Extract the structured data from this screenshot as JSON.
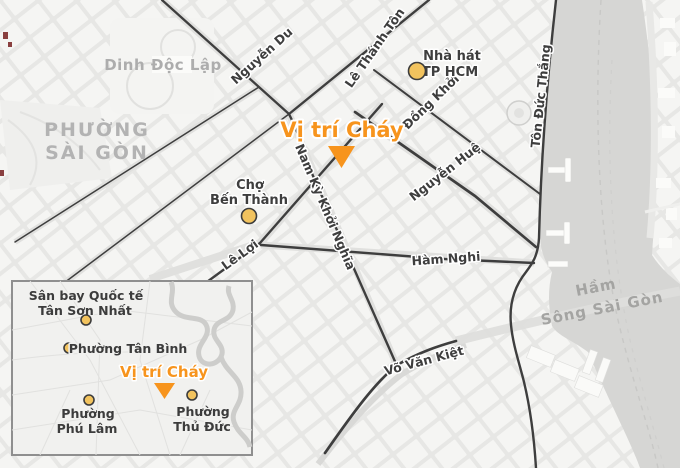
{
  "title": "Vị trí Cháy — bản đồ TP HCM",
  "colors": {
    "accent_orange": "#F7941D",
    "marker_yellow": "#F2C35E",
    "road_dark": "#3E3E3E",
    "river_gray": "#D7D7D5",
    "area_label_gray": "#B3B3B3"
  },
  "main_map": {
    "fire_label": "Vị trí Cháy",
    "areas": {
      "phuong_saigon_line1": "PHƯỜNG",
      "phuong_saigon_line2": "SÀI GÒN",
      "dinh_doc_lap": "Dinh Độc Lập",
      "ham_line1": "Hầm",
      "ham_line2": "Sông Sài Gòn"
    },
    "streets": {
      "nguyen_du": "Nguyễn Du",
      "le_thanh_ton": "Lê Thánh Tôn",
      "dong_khoi": "Đồng Khởi",
      "nguyen_hue": "Nguyễn Huệ",
      "nam_ky_khoi_nghia": "Nam Kỳ Khởi Nghĩa",
      "ton_duc_thang": "Tôn Đức Thắng",
      "le_loi": "Lê Lợi",
      "ham_nghi": "Hàm Nghi",
      "vo_van_kiet": "Võ Văn Kiệt"
    },
    "pois": {
      "cho_ben_thanh_line1": "Chợ",
      "cho_ben_thanh_line2": "Bến Thành",
      "nha_hat_line1": "Nhà hát",
      "nha_hat_line2": "TP HCM"
    }
  },
  "inset_map": {
    "fire_label": "Vị trí Cháy",
    "pois": {
      "airport_line1": "Sân bay Quốc tế",
      "airport_line2": "Tân Sơn Nhất",
      "tan_binh": "Phường Tân Bình",
      "phu_lam_line1": "Phường",
      "phu_lam_line2": "Phú Lâm",
      "thu_duc_line1": "Phường",
      "thu_duc_line2": "Thủ Đức"
    }
  }
}
